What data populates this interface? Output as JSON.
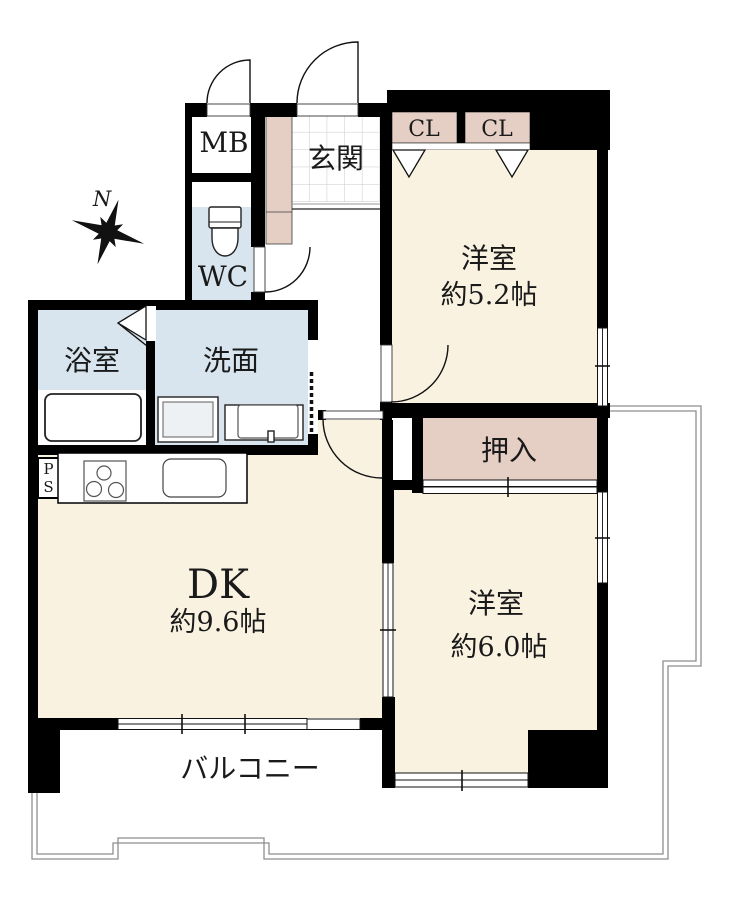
{
  "compass": {
    "label": "N"
  },
  "rooms": {
    "meter_box": {
      "label": "MB"
    },
    "entrance": {
      "label": "玄関"
    },
    "toilet": {
      "label": "WC"
    },
    "closet_left": {
      "label": "CL"
    },
    "closet_right": {
      "label": "CL"
    },
    "western_room_1": {
      "label": "洋室",
      "size": "約5.2帖"
    },
    "bathroom": {
      "label": "浴室"
    },
    "washroom": {
      "label": "洗面"
    },
    "pipe_space": {
      "line1": "P",
      "line2": "S"
    },
    "dining_kitchen": {
      "label": "DK",
      "size": "約9.6帖"
    },
    "oshiire": {
      "label": "押入"
    },
    "western_room_2": {
      "label": "洋室",
      "size": "約6.0帖"
    },
    "balcony": {
      "label": "バルコニー"
    }
  },
  "colors": {
    "wall": "#000000",
    "room_floor": "#FAF2E1",
    "closet": "#E5CFC5",
    "wet_area": "#D8E5EE",
    "balcony_outline": "#8E8E8E",
    "tile_grid": "#C7CAD2",
    "background": "#FFFFFF"
  }
}
